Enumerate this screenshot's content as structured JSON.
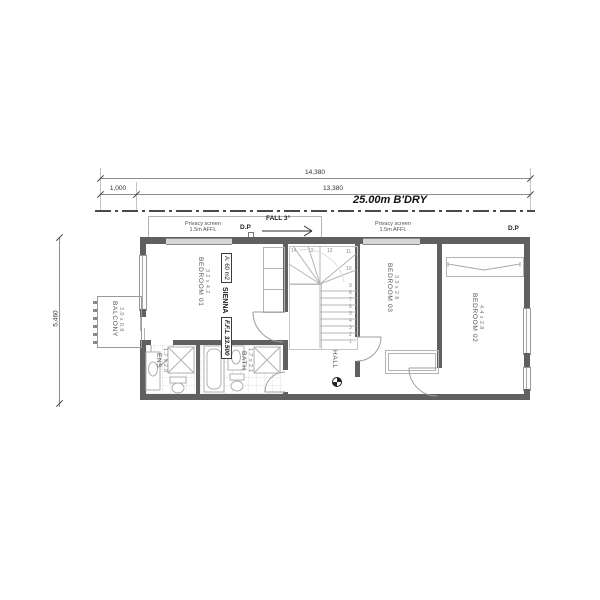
{
  "dims": {
    "total": "14,380",
    "offset": "1,000",
    "inner": "13,380",
    "side": "5,460",
    "boundary": "25.00m B'DRY"
  },
  "notes": {
    "privacy_screen_line1": "Privacy screen",
    "privacy_screen_line2": "1.5m AFFL",
    "dp": "D.P",
    "fall": "FALL 3°",
    "ffl": "F.F.L 33.500",
    "series": "SIENNA",
    "area": "A: 60 m2",
    "hall": "HALL"
  },
  "rooms": {
    "bed1": {
      "name": "BEDROOM 01",
      "dims": "3.2 x 4.2"
    },
    "bed2": {
      "name": "BEDROOM 02",
      "dims": "4.4 x 2.8"
    },
    "bed3": {
      "name": "BEDROOM 03",
      "dims": "3.3 x 2.8"
    },
    "balcony": {
      "name": "BALCONY",
      "dims": "3.0 x 0.9"
    },
    "ens": {
      "name": "ENS",
      "dims": "1.7 x 2.0"
    },
    "bath": {
      "name": "BATH",
      "dims": "1.7 x 2.1"
    }
  },
  "stairs": {
    "numbers": [
      "1",
      "2",
      "3",
      "4",
      "5",
      "6",
      "7",
      "8",
      "9",
      "10",
      "11",
      "12",
      "13",
      "14"
    ]
  },
  "colors": {
    "wall": "#606060",
    "fixture_line": "#b0b0b0",
    "text": "#4a4a4a"
  }
}
